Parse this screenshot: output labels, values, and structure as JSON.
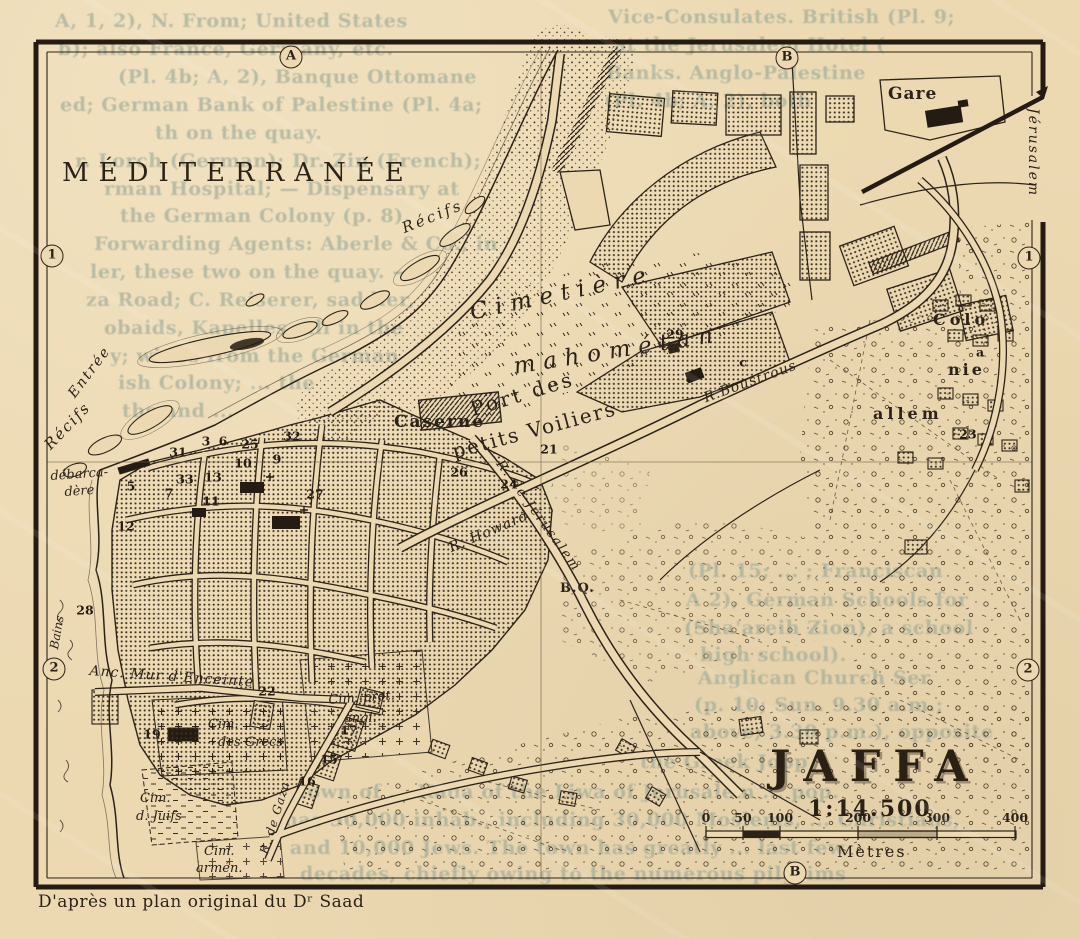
{
  "map": {
    "title": "JAFFA",
    "scale_ratio": "1:14.500",
    "scale_unit": "Mètres",
    "attribution": "D'après un plan original du Dʳ Saad",
    "sea_label": "MÉDITERRANÉE",
    "colors": {
      "paper": "#ecd9b2",
      "ink": "#2c2318",
      "stipple": "#3b2f20",
      "bleed": "#96a797"
    },
    "scale_bar": {
      "ticks": [
        {
          "v": "0",
          "x": 706
        },
        {
          "v": "50",
          "x": 743
        },
        {
          "v": "100",
          "x": 780
        },
        {
          "v": "200",
          "x": 858
        },
        {
          "v": "300",
          "x": 937
        },
        {
          "v": "400",
          "x": 1015
        }
      ]
    },
    "edge_markers": [
      {
        "t": "A",
        "x": 291,
        "y": 57
      },
      {
        "t": "B",
        "x": 787,
        "y": 58
      },
      {
        "t": "1",
        "x": 52,
        "y": 256
      },
      {
        "t": "1",
        "x": 1029,
        "y": 258
      },
      {
        "t": "2",
        "x": 54,
        "y": 669
      },
      {
        "t": "2",
        "x": 1028,
        "y": 670
      },
      {
        "t": "B",
        "x": 795,
        "y": 873
      }
    ],
    "labels": [
      {
        "n": "recifs-north-label",
        "t": "Récifs",
        "x": 400,
        "y": 222,
        "s": 15,
        "r": -22,
        "it": 1,
        "ls": 3
      },
      {
        "n": "recifs-west-label",
        "t": "Récifs",
        "x": 42,
        "y": 442,
        "s": 15,
        "r": -46,
        "it": 1,
        "ls": 2
      },
      {
        "n": "entree-label",
        "t": "Entrée",
        "x": 66,
        "y": 392,
        "s": 14,
        "r": -53,
        "it": 1,
        "ls": 2
      },
      {
        "n": "port-label-line1",
        "t": "Port des",
        "x": 468,
        "y": 400,
        "s": 20,
        "r": -17,
        "ls": 3
      },
      {
        "n": "port-label-line2",
        "t": "petits Voiliers",
        "x": 450,
        "y": 442,
        "s": 20,
        "r": -15,
        "ls": 2
      },
      {
        "n": "debarcadere-label-1",
        "t": "débarca-",
        "x": 50,
        "y": 470,
        "s": 13,
        "r": -4,
        "it": 1
      },
      {
        "n": "debarcadere-label-2",
        "t": "dère",
        "x": 64,
        "y": 486,
        "s": 13,
        "r": -4,
        "it": 1
      },
      {
        "n": "bains-label",
        "t": "Bains",
        "x": 48,
        "y": 648,
        "s": 12,
        "r": -80,
        "it": 1
      },
      {
        "n": "cimetiere-label-1",
        "t": "Cimetière",
        "x": 468,
        "y": 302,
        "s": 23,
        "r": -12,
        "it": 1,
        "ls": 8
      },
      {
        "n": "cimetiere-label-2",
        "t": "mahométan",
        "x": 512,
        "y": 356,
        "s": 23,
        "r": -9,
        "it": 1,
        "ls": 8
      },
      {
        "n": "caserne-label",
        "t": "Caserne",
        "x": 394,
        "y": 414,
        "s": 17,
        "ls": 2,
        "bd": 1
      },
      {
        "n": "rue-howard-label",
        "t": "R. Howard",
        "x": 447,
        "y": 542,
        "s": 14,
        "r": -23,
        "it": 1,
        "ls": 1
      },
      {
        "n": "rue-boustrous-label",
        "t": "R.Boustrous",
        "x": 702,
        "y": 392,
        "s": 14,
        "r": -20,
        "it": 1,
        "ls": 1
      },
      {
        "n": "rue-jerusalem-label",
        "t": "R. de Jérusalem",
        "x": 504,
        "y": 458,
        "s": 13,
        "r": 54,
        "it": 1,
        "ls": 2
      },
      {
        "n": "rue-gaza-label",
        "t": "R. de Gaza",
        "x": 258,
        "y": 852,
        "s": 12,
        "r": -73,
        "it": 1,
        "ls": 1
      },
      {
        "n": "anc-mur-label",
        "t": "Anc. Mur d'Enceinte",
        "x": 90,
        "y": 664,
        "s": 14,
        "r": 4,
        "it": 1,
        "ls": 1
      },
      {
        "n": "cim-grecs-label-1",
        "t": "Cim.",
        "x": 208,
        "y": 718,
        "s": 13,
        "it": 1
      },
      {
        "n": "cim-grecs-label-2",
        "t": "des Grecs",
        "x": 218,
        "y": 736,
        "s": 13,
        "it": 1
      },
      {
        "n": "cim-juifs-label-1",
        "t": "Cim.",
        "x": 140,
        "y": 792,
        "s": 13,
        "it": 1
      },
      {
        "n": "cim-juifs-label-2",
        "t": "d. Juifs",
        "x": 136,
        "y": 810,
        "s": 13,
        "it": 1
      },
      {
        "n": "cim-armen-label-1",
        "t": "Cim.",
        "x": 204,
        "y": 845,
        "s": 13,
        "it": 1
      },
      {
        "n": "cim-armen-label-2",
        "t": "armén.",
        "x": 196,
        "y": 862,
        "s": 13,
        "it": 1
      },
      {
        "n": "cim-prot-label-1",
        "t": "Cim. prot.",
        "x": 328,
        "y": 694,
        "s": 13,
        "r": -4,
        "it": 1
      },
      {
        "n": "cim-prot-label-2",
        "t": "angl.",
        "x": 344,
        "y": 712,
        "s": 13,
        "it": 1
      },
      {
        "n": "colonie-label-1",
        "t": "Colo",
        "x": 933,
        "y": 312,
        "s": 16,
        "ls": 4,
        "bd": 1
      },
      {
        "n": "colonie-label-2",
        "t": "nie",
        "x": 948,
        "y": 362,
        "s": 16,
        "ls": 3,
        "bd": 1
      },
      {
        "n": "colonie-label-3",
        "t": "allem",
        "x": 873,
        "y": 406,
        "s": 16,
        "ls": 4,
        "bd": 1
      },
      {
        "n": "gare-label",
        "t": "Gare",
        "x": 888,
        "y": 86,
        "s": 17,
        "ls": 1,
        "bd": 1
      },
      {
        "n": "jerusalem-direction-label",
        "t": "Jérusalem",
        "x": 1040,
        "y": 108,
        "s": 14,
        "r": 90,
        "it": 1,
        "ls": 2
      },
      {
        "n": "bq-label",
        "t": "B.Q.",
        "x": 560,
        "y": 582,
        "s": 13,
        "bd": 1,
        "ls": 1
      }
    ],
    "numbers": [
      {
        "t": "3",
        "x": 206,
        "y": 441
      },
      {
        "t": "6",
        "x": 223,
        "y": 441
      },
      {
        "t": "31",
        "x": 178,
        "y": 452
      },
      {
        "t": "25",
        "x": 250,
        "y": 444
      },
      {
        "t": "32",
        "x": 292,
        "y": 436
      },
      {
        "t": "10",
        "x": 243,
        "y": 463
      },
      {
        "t": "9",
        "x": 277,
        "y": 459
      },
      {
        "t": "5",
        "x": 131,
        "y": 486
      },
      {
        "t": "7",
        "x": 169,
        "y": 493
      },
      {
        "t": "33",
        "x": 185,
        "y": 479
      },
      {
        "t": "13",
        "x": 213,
        "y": 477
      },
      {
        "t": "11",
        "x": 211,
        "y": 501
      },
      {
        "t": "12",
        "x": 126,
        "y": 526
      },
      {
        "t": "28",
        "x": 85,
        "y": 610
      },
      {
        "t": "22",
        "x": 267,
        "y": 691
      },
      {
        "t": "19",
        "x": 152,
        "y": 734
      },
      {
        "t": "17",
        "x": 349,
        "y": 730
      },
      {
        "t": "15",
        "x": 329,
        "y": 759
      },
      {
        "t": "16",
        "x": 307,
        "y": 781
      },
      {
        "t": "21",
        "x": 549,
        "y": 449
      },
      {
        "t": "24",
        "x": 509,
        "y": 484
      },
      {
        "t": "26",
        "x": 459,
        "y": 472
      },
      {
        "t": "27",
        "x": 315,
        "y": 494
      },
      {
        "t": "29",
        "x": 675,
        "y": 334
      },
      {
        "t": "8",
        "x": 690,
        "y": 378
      },
      {
        "t": "23",
        "x": 968,
        "y": 434
      },
      {
        "t": "a",
        "x": 980,
        "y": 352
      },
      {
        "t": "c",
        "x": 743,
        "y": 362
      }
    ],
    "bleed_text": [
      {
        "t": "A, 1, 2), N. From; United States",
        "x": 55,
        "y": 10
      },
      {
        "t": "Vice-Consulates. British (Pl. 9;",
        "x": 608,
        "y": 6
      },
      {
        "t": "b); also France, Germany, etc.",
        "x": 58,
        "y": 38
      },
      {
        "t": "at the Jerusalem Hotel (",
        "x": 614,
        "y": 34
      },
      {
        "t": "(Pl. 4b; A, 2), Banque Ottomane",
        "x": 118,
        "y": 66
      },
      {
        "t": "Banks. Anglo-Palestine",
        "x": 606,
        "y": 62
      },
      {
        "t": "ed; German Bank of Palestine (Pl. 4a;",
        "x": 60,
        "y": 94
      },
      {
        "t": "(Pl. 4b; A, 2), both",
        "x": 604,
        "y": 90
      },
      {
        "t": "th on the quay.",
        "x": 155,
        "y": 122
      },
      {
        "t": "r. Lorch (German); Dr. Zin (French);",
        "x": 75,
        "y": 150
      },
      {
        "t": "rman Hospital; — Dispensary at",
        "x": 104,
        "y": 178
      },
      {
        "t": "the German Colony (p. 8).",
        "x": 120,
        "y": 205
      },
      {
        "t": "Forwarding Agents: Aberle & Co., in",
        "x": 94,
        "y": 233
      },
      {
        "t": "ler, these two on the quay. —",
        "x": 90,
        "y": 261
      },
      {
        "t": "za Road; C. Reiserer, saddler,",
        "x": 86,
        "y": 289
      },
      {
        "t": "obaids, Kapelles, all in the",
        "x": 104,
        "y": 317
      },
      {
        "t": "y; wines from the German",
        "x": 110,
        "y": 345
      },
      {
        "t": "ish Colony; ... the",
        "x": 118,
        "y": 372
      },
      {
        "t": "ths and ...",
        "x": 122,
        "y": 400
      },
      {
        "t": "(Pl. 15; ... ; Franciscan",
        "x": 688,
        "y": 560
      },
      {
        "t": "A 2), German Schools for",
        "x": 686,
        "y": 589
      },
      {
        "t": "(Sha'areih Zion), a school",
        "x": 684,
        "y": 617
      },
      {
        "t": "high school).",
        "x": 700,
        "y": 644
      },
      {
        "t": "Anglican Church Ser",
        "x": 698,
        "y": 667
      },
      {
        "t": "(p. 10; Sun. 9.30 a.m.;",
        "x": 694,
        "y": 694
      },
      {
        "t": "above; 3.30 p.m.), opposite",
        "x": 690,
        "y": 721
      },
      {
        "t": "the Greek Jopp",
        "x": 640,
        "y": 751
      },
      {
        "t": "town of ... Kadá of the Liwa of Jerusalem ... pop.",
        "x": 298,
        "y": 781
      },
      {
        "t": "has 50,000 inhab., including 30,000 Moslems, ... Christians,",
        "x": 284,
        "y": 809
      },
      {
        "t": "and 10,000 Jews.  The town has greatly ... last few",
        "x": 290,
        "y": 837
      },
      {
        "t": "decades, chiefly owing to the numerous pilgrims",
        "x": 300,
        "y": 863
      }
    ]
  }
}
